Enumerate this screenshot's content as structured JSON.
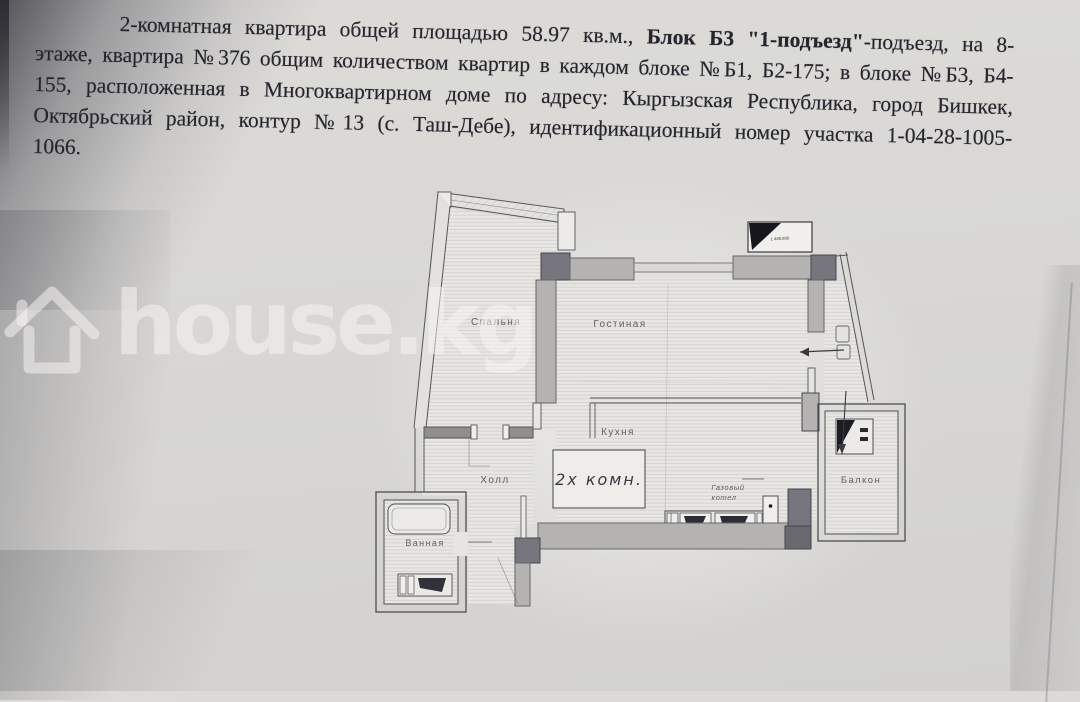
{
  "document": {
    "lines": [
      {
        "pre": "2-комнатная квартира общей площадью 58.97 кв.м., ",
        "bold": "Блок Б3 \"1-подъезд\"",
        "post": "-подъезд, на 8-"
      },
      {
        "text": "этаже, квартира №376 общим количеством квартир в каждом блоке №Б1, Б2-175; в блоке №Б3, Б4-"
      },
      {
        "text": "155, расположенная в Многоквартирном доме по адресу: Кыргызская Республика, город Бишкек,"
      },
      {
        "text": "Октябрьский район, контур №13 (с. Таш-Дебе), идентификационный номер участка 1-04-28-1005-"
      },
      {
        "text": "1066."
      }
    ]
  },
  "watermark": {
    "brand": "house.kg",
    "icon": "house-icon"
  },
  "floorplan": {
    "rooms": {
      "bedroom": "Спальня",
      "living_room": "Гостиная",
      "kitchen": "Кухня",
      "hall": "Холл",
      "bathroom": "Ванная",
      "balcony": "Балкон"
    },
    "labels": {
      "apartment_type": "2х комн.",
      "gas_boiler_line1": "Газовый",
      "gas_boiler_line2": "котел",
      "elevation_mark": "1 480.800"
    }
  },
  "colors": {
    "paper": "#d8d7d4",
    "plan_paper": "#e7e6e2",
    "wall_light": "#b4b3b1",
    "column_dark": "#77767e",
    "plan_line": "#55545a",
    "text": "#26242c",
    "watermark": "rgba(247,246,244,0.52)"
  }
}
